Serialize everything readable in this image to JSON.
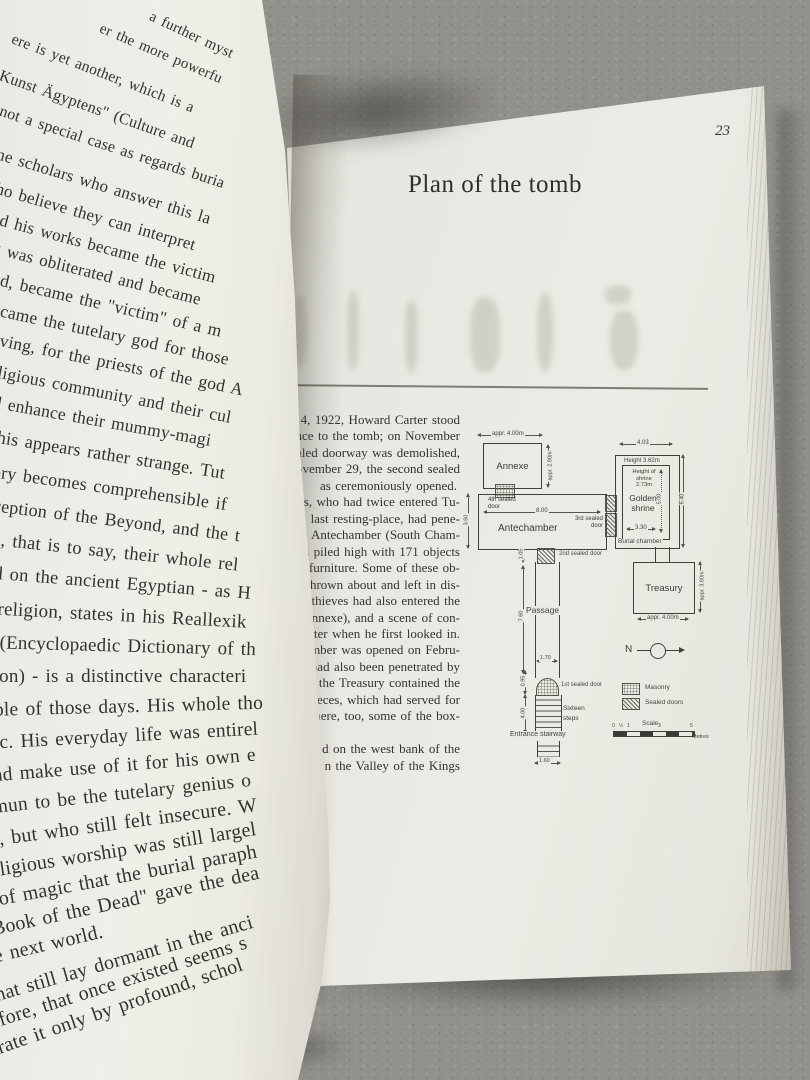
{
  "page_right": {
    "page_number": "23",
    "title": "Plan of the tomb",
    "body_lines": [
      "ber 4, 1922, Howard Carter stood",
      "ance to the tomb; on November",
      "sealed doorway was demolished,",
      "ovember 29, the second sealed",
      "as ceremoniously opened.",
      "ers, who had twice entered Tu-",
      "'s last resting-place, had pene-",
      "he Antechamber (South Cham-",
      "was piled high with 171 objects",
      "of furniture. Some of these ob-",
      "en thrown about and left in dis-",
      "thieves had also entered the",
      "er (Annexe), and a scene of con-",
      "Carter when he first looked in.",
      "Chamber was opened on Febru-",
      ". It had also been penetrated by",
      "ers; the Treasury contained the",
      "us pieces, which had served for",
      "ites; there, too, some of the box-",
      "rifled.",
      "situated on the west bank of the",
      "uxor in the Valley of the Kings",
      "uluk)."
    ],
    "diagram": {
      "rooms": {
        "annexe": "Annexe",
        "antechamber": "Antechamber",
        "golden_shrine_1": "Golden",
        "golden_shrine_2": "shrine",
        "burial_chamber": "Burial chamber",
        "treasury": "Treasury",
        "passage": "Passage",
        "entrance": "Entrance stairway"
      },
      "doors": {
        "d4a": "4th sealed",
        "d4b": "door",
        "d3a": "3rd sealed",
        "d3b": "door",
        "d2": "2nd sealed door",
        "d1": "1st sealed door"
      },
      "dims": {
        "annexe_w": "appr. 4.00m",
        "annexe_h": "appr. 2.90m",
        "ante_w": "8.00",
        "ante_h": "3.60",
        "burial_w": "4.03",
        "burial_h": "6.40",
        "chamber_height": "Height 3.62m",
        "shrine_height_1": "Height of",
        "shrine_height_2": "shrine",
        "shrine_height_3": "2.73m",
        "shrine_len": "5.00",
        "shrine_w": "3.30",
        "door2_gap": "1.05",
        "passage_len": "7.60",
        "passage_w": "1.70",
        "door1_len": "0.95",
        "stairs_len": "4.00",
        "stairs_w": "1.60",
        "treasury_h": "appr. 3.80m",
        "treasury_w": "appr. 4.00m"
      },
      "labels": {
        "steps_1": "Sixteen",
        "steps_2": "steps",
        "north": "N"
      },
      "legend": {
        "masonry": "Masonry",
        "sealed_doors": "Sealed doors",
        "scale": "Scale",
        "metres": "Metres",
        "scale_ticks": [
          "0",
          "½",
          "1",
          "3",
          "5"
        ]
      }
    }
  },
  "page_left": {
    "lines": [
      "a further myst",
      "er the more powerfu",
      "ere is yet another, which is a",
      "d Kunst Ägyptens\" (Culture and",
      "n not a special case as regards buria",
      "ome scholars who answer this la",
      "who believe they can interpret",
      "and his works became the victim",
      "ng was obliterated and became",
      "and, became the \"victim\" of a m",
      "became the tutelary god for those",
      "living, for the priests of the god A",
      "religious community and their cul",
      "nd enhance their mummy-magi",
      "this appears rather strange. Tut",
      "eory becomes comprehensible if",
      "nception of the Beyond, and the t",
      "ns, that is to say, their whole rel",
      "nd on the ancient Egyptian - as H",
      "f religion, states in his Reallexik",
      "e (Encyclopaedic Dictionary of th",
      "gion) - is a distinctive characteri",
      "ople of those days. His whole tho",
      "gic. His everyday life was entirel",
      "and make use of it for his own e",
      "amun to be the tutelary genius o",
      "er, but who still felt insecure. W",
      "religious worship was still largel",
      "s of magic that the burial paraph",
      "\"Book of the Dead\" gave the dea",
      "he next world.",
      "that still lay dormant in the anci",
      "refore, that once existed seems s",
      "etrate it only by profound, schol"
    ]
  }
}
